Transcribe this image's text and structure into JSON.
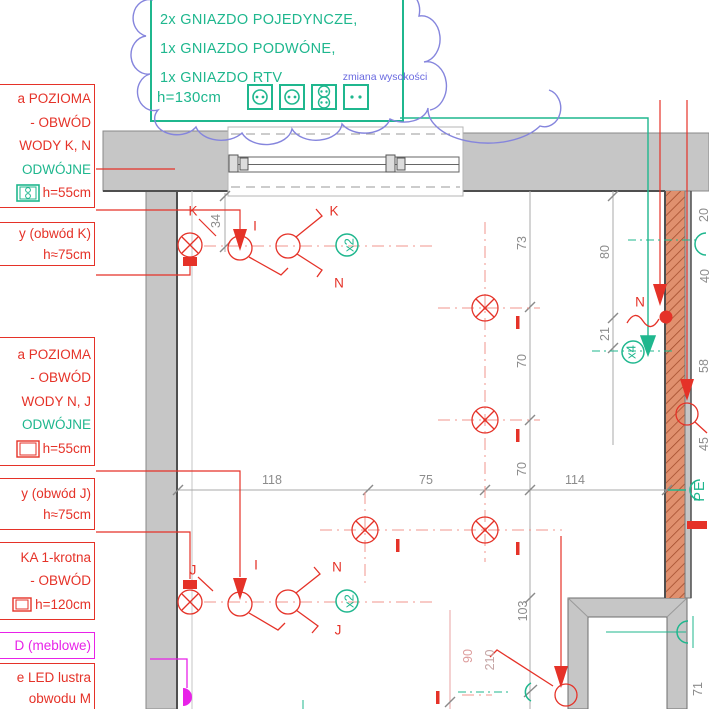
{
  "callout": {
    "title": "RAMKA 4-krotna, POZIOMA",
    "line1": "2x GNIAZDO POJEDYNCZE,",
    "line2": "1x GNIAZDO PODWÓNE,",
    "line3": "1x GNIAZDO RTV",
    "height": "h=130cm",
    "note": "zmiana wysokości"
  },
  "sidebar": {
    "box1": {
      "l1": "a POZIOMA",
      "l2": "- OBWÓD",
      "l3": "WODY K, N",
      "l4": "ODWÓJNE",
      "l5": "h=55cm"
    },
    "box2": {
      "l1": "y (obwód K)",
      "l2": "h≈75cm"
    },
    "box3": {
      "l1": "a POZIOMA",
      "l2": "- OBWÓD",
      "l3": "WODY N, J",
      "l4": "ODWÓJNE",
      "l5": "h=55cm"
    },
    "box4": {
      "l1": "y (obwód J)",
      "l2": "h≈75cm"
    },
    "box5": {
      "l1": "KA 1-krotna",
      "l2": "- OBWÓD",
      "l3": "h=120cm"
    },
    "box6": {
      "l1": "D (meblowe)"
    },
    "box7": {
      "l1": "e LED lustra",
      "l2": "obwodu M"
    }
  },
  "dims": {
    "d118": "118",
    "d75": "75",
    "d114": "114",
    "d34": "34",
    "d73": "73",
    "d70a": "70",
    "d70b": "70",
    "d103": "103",
    "d80": "80",
    "d21": "21",
    "d20": "20",
    "d40": "40",
    "d58": "58",
    "d45": "45",
    "d71": "71",
    "d90": "90",
    "d210": "210"
  },
  "marks": {
    "k_wall": "K",
    "i_top": "I",
    "k_switch": "K",
    "n_switch": "N",
    "x2_top": "x2",
    "n_right": "N",
    "x4": "x4",
    "pe": "PE",
    "j_wall": "J",
    "i_bottom": "I",
    "n_switch2": "N",
    "j_switch": "J",
    "x2_bottom": "x2"
  },
  "colors": {
    "red": "#e53228",
    "teal": "#1fb78e",
    "magenta": "#e822e8",
    "cloud_blue": "#8585dd",
    "wall_gray": "#c6c6c6",
    "hatch_salmon": "#e0906e",
    "dim_gray": "#8c8c8c"
  }
}
